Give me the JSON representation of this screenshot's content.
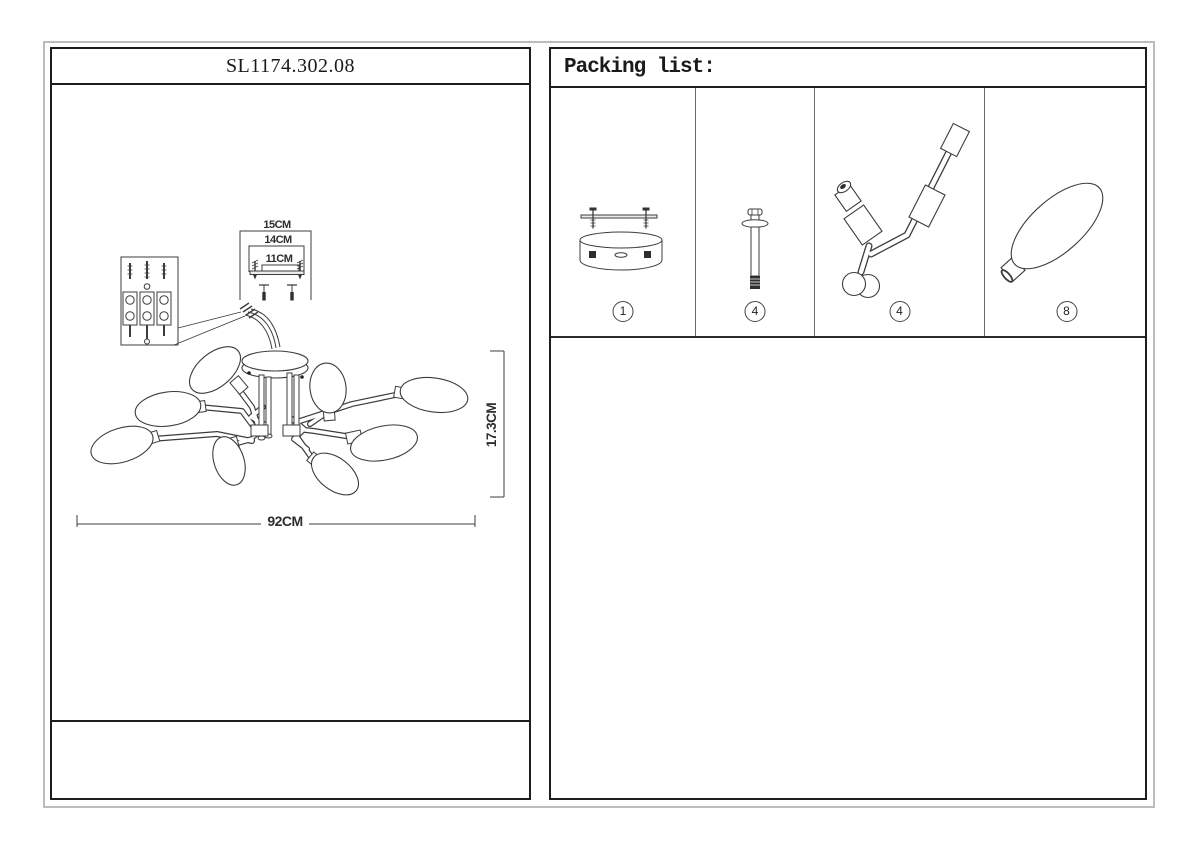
{
  "sheet": {
    "left": {
      "title": "SL1174.302.08",
      "dims": {
        "w15": "15CM",
        "w14": "14CM",
        "w11": "11CM",
        "height": "17.3CM",
        "width": "92CM"
      }
    },
    "right": {
      "header": "Packing list:",
      "items": [
        {
          "icon": "canopy-mount-drawing",
          "qty": "1"
        },
        {
          "icon": "hanging-screw-drawing",
          "qty": "4"
        },
        {
          "icon": "lamp-arm-drawing",
          "qty": "4"
        },
        {
          "icon": "glass-shade-drawing",
          "qty": "8"
        }
      ]
    }
  }
}
